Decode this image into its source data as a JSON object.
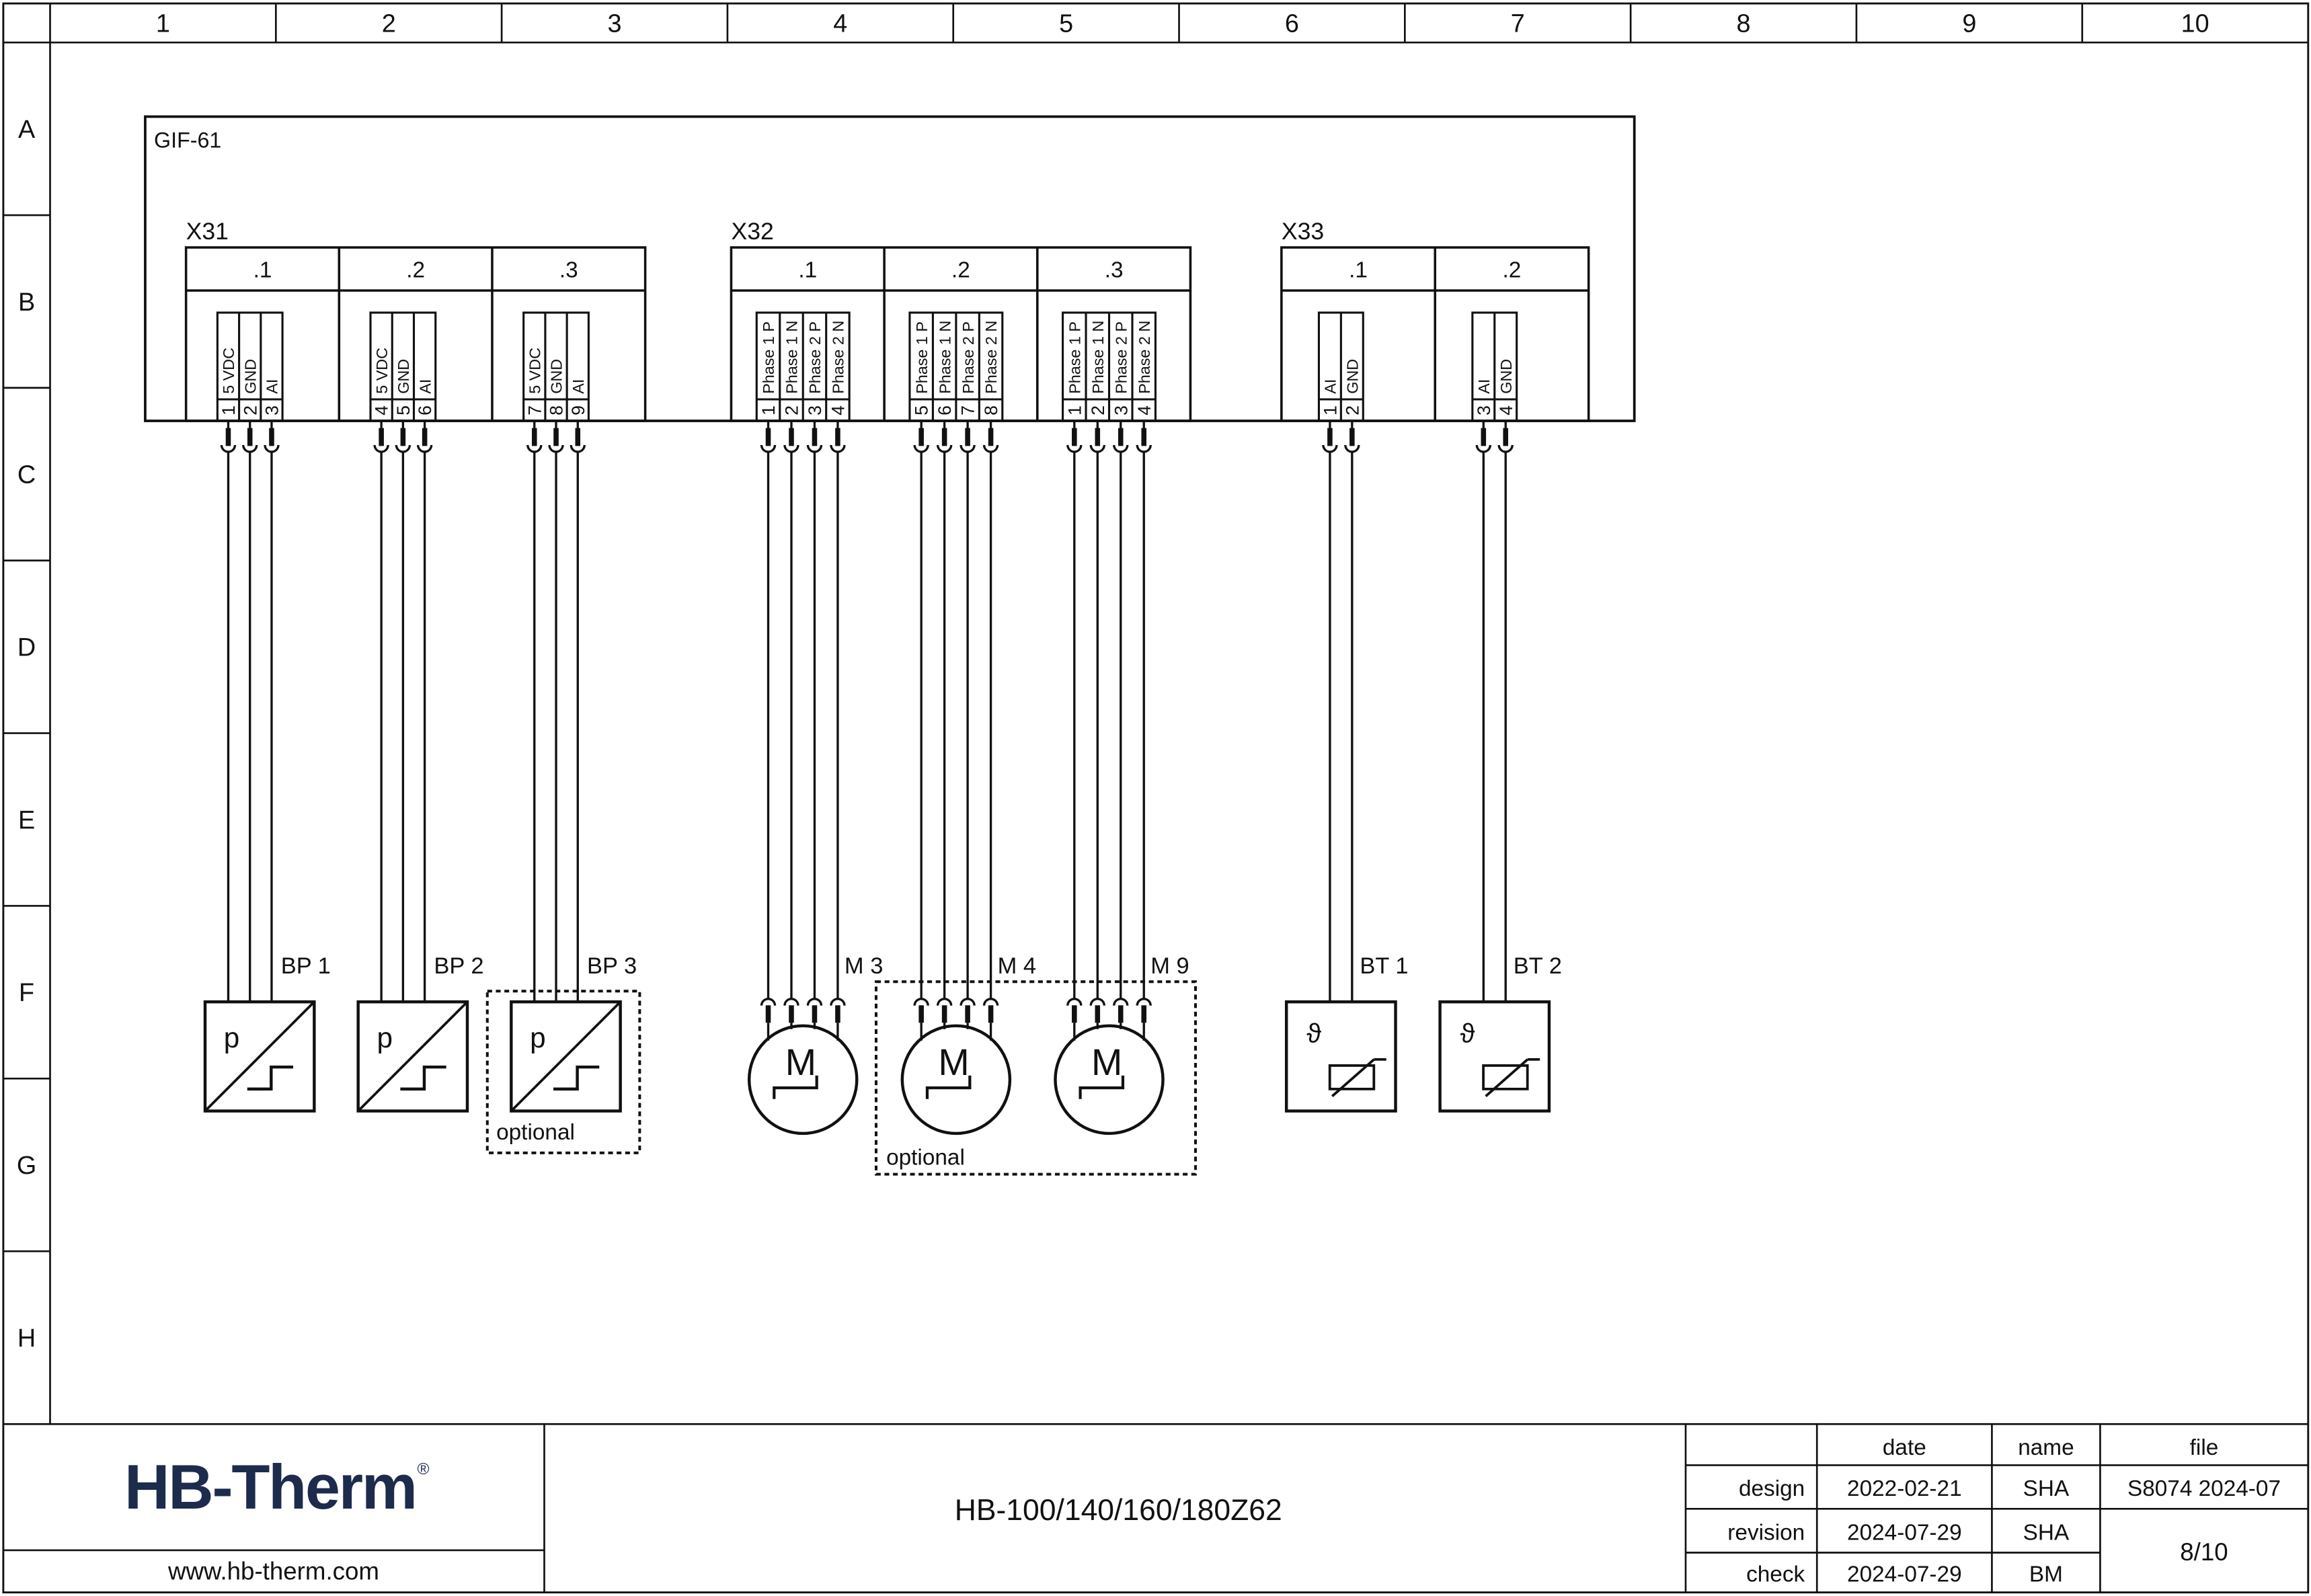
{
  "page": {
    "background": "#ffffff",
    "line_color": "#111111"
  },
  "ruler": {
    "columns": [
      "1",
      "2",
      "3",
      "4",
      "5",
      "6",
      "7",
      "8",
      "9",
      "10"
    ],
    "rows": [
      "A",
      "B",
      "C",
      "D",
      "E",
      "F",
      "G",
      "H"
    ]
  },
  "frame": {
    "label": "GIF-61"
  },
  "connectors": [
    {
      "id": "X31",
      "sections": [
        {
          "label": ".1",
          "pins": [
            {
              "no": "1",
              "signal": "5 VDC"
            },
            {
              "no": "2",
              "signal": "GND"
            },
            {
              "no": "3",
              "signal": "AI"
            }
          ]
        },
        {
          "label": ".2",
          "pins": [
            {
              "no": "4",
              "signal": "5 VDC"
            },
            {
              "no": "5",
              "signal": "GND"
            },
            {
              "no": "6",
              "signal": "AI"
            }
          ]
        },
        {
          "label": ".3",
          "pins": [
            {
              "no": "7",
              "signal": "5 VDC"
            },
            {
              "no": "8",
              "signal": "GND"
            },
            {
              "no": "9",
              "signal": "AI"
            }
          ]
        }
      ]
    },
    {
      "id": "X32",
      "sections": [
        {
          "label": ".1",
          "pins": [
            {
              "no": "1",
              "signal": "Phase 1 P"
            },
            {
              "no": "2",
              "signal": "Phase 1 N"
            },
            {
              "no": "3",
              "signal": "Phase 2 P"
            },
            {
              "no": "4",
              "signal": "Phase 2 N"
            }
          ]
        },
        {
          "label": ".2",
          "pins": [
            {
              "no": "5",
              "signal": "Phase 1 P"
            },
            {
              "no": "6",
              "signal": "Phase 1 N"
            },
            {
              "no": "7",
              "signal": "Phase 2 P"
            },
            {
              "no": "8",
              "signal": "Phase 2 N"
            }
          ]
        },
        {
          "label": ".3",
          "pins": [
            {
              "no": "1",
              "signal": "Phase 1 P"
            },
            {
              "no": "2",
              "signal": "Phase 1 N"
            },
            {
              "no": "3",
              "signal": "Phase 2 P"
            },
            {
              "no": "4",
              "signal": "Phase 2 N"
            }
          ]
        }
      ]
    },
    {
      "id": "X33",
      "sections": [
        {
          "label": ".1",
          "pins": [
            {
              "no": "1",
              "signal": "AI"
            },
            {
              "no": "2",
              "signal": "GND"
            }
          ]
        },
        {
          "label": ".2",
          "pins": [
            {
              "no": "3",
              "signal": "AI"
            },
            {
              "no": "4",
              "signal": "GND"
            }
          ]
        }
      ]
    }
  ],
  "devices": {
    "pressure_sensors": [
      {
        "label": "BP 1",
        "symbol": "p",
        "optional": false
      },
      {
        "label": "BP 2",
        "symbol": "p",
        "optional": false
      },
      {
        "label": "BP 3",
        "symbol": "p",
        "optional": true
      }
    ],
    "motors": [
      {
        "label": "M 3",
        "symbol": "M",
        "optional": false
      },
      {
        "label": "M 4",
        "symbol": "M",
        "optional": true
      },
      {
        "label": "M 9",
        "symbol": "M",
        "optional": true
      }
    ],
    "temperature_sensors": [
      {
        "label": "BT 1",
        "symbol": "ϑ",
        "optional": false
      },
      {
        "label": "BT 2",
        "symbol": "ϑ",
        "optional": false
      }
    ],
    "optional_label": "optional"
  },
  "title_block": {
    "logo": "HB-Therm",
    "registered": "®",
    "logo_color": "#1d2b4d",
    "website": "www.hb-therm.com",
    "drawing_title": "HB-100/140/160/180Z62",
    "table": {
      "headers": [
        "date",
        "name",
        "file"
      ],
      "rows": [
        {
          "label": "design",
          "date": "2022-02-21",
          "name": "SHA",
          "file": "S8074 2024-07"
        },
        {
          "label": "revision",
          "date": "2024-07-29",
          "name": "SHA",
          "file": ""
        },
        {
          "label": "check",
          "date": "2024-07-29",
          "name": "BM",
          "file": ""
        }
      ],
      "page_info": "8/10"
    }
  }
}
